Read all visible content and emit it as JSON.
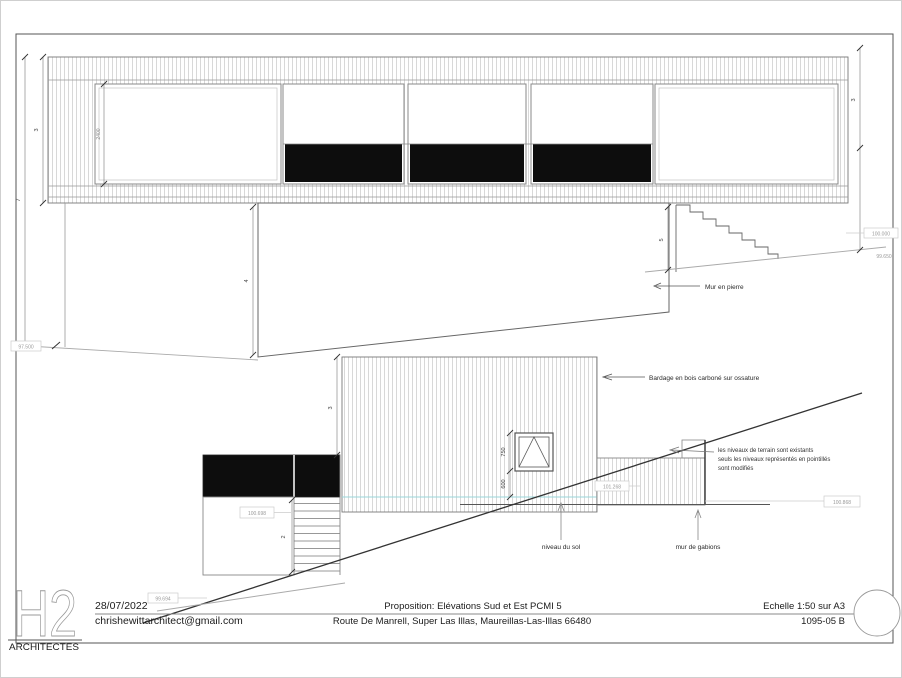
{
  "title_block": {
    "date": "28/07/2022",
    "email": "chrishewittarchitect@gmail.com",
    "project_title": "Proposition: Elévations Sud et Est PCMI 5",
    "project_address": "Route De Manrell, Super Las Illas, Maureillas-Las-Illas 66480",
    "scale": "Echelle 1:50 sur A3",
    "drawing_number": "1095-05 B",
    "logo_text": "H2",
    "firm_name": "ARCHITECTES"
  },
  "annotations": {
    "stone_wall": "Mur en pierre",
    "cladding": "Bardage en bois carboné sur ossature",
    "levels_note_line1": "les niveaux de terrain sont existants",
    "levels_note_line2": "seuls les niveaux représentés en pointillés",
    "levels_note_line3": "sont modifiés",
    "ground_level": "niveau du sol",
    "gabion_wall": "mur de gabions"
  },
  "spot_levels": {
    "upper_left": "97.500",
    "upper_right_top": "100.000",
    "upper_right_bottom": "99.650",
    "annex": "100.698",
    "volume_right": "101.268",
    "gabion_right": "100.868",
    "bottom_left": "99.694"
  },
  "dimensions": {
    "upper_inner_height": "3",
    "upper_total_height": "7",
    "upper_window_height": "2400",
    "upper_right_height": "3",
    "stone_wall_height": "4",
    "upper_stairs_height": "5",
    "lower_volume_height": "3",
    "lower_window_height": "750",
    "lower_sill_height": "600",
    "annex_stairs_height": "2"
  },
  "colors": {
    "glazing_dark": "#0d0d0d",
    "hatch_line": "#c8c8c8",
    "ground_accent": "#9ad6da",
    "terrain_modified": "#333333",
    "terrain_existing": "#aaaaaa"
  }
}
